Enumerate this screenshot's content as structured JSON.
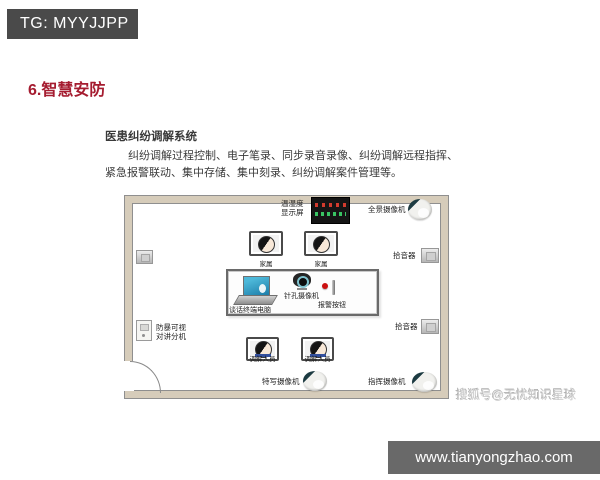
{
  "header": {
    "tg_badge": "TG: MYYJJPP",
    "title": "6.智慧安防"
  },
  "content": {
    "system_title": "医患纠纷调解系统",
    "description_line1": "纠纷调解过程控制、电子笔录、同步录音录像、纠纷调解远程指挥、",
    "description_line2": "紧急报警联动、集中存储、集中刻录、纠纷调解案件管理等。"
  },
  "diagram": {
    "temp_display_label": [
      "温湿度",
      "显示屏"
    ],
    "panoramic_camera_label": "全景摄像机",
    "family_labels": [
      "家属",
      "家属"
    ],
    "pickup_labels": [
      "拾音器",
      "拾音器"
    ],
    "intercom_label": [
      "防暴可视",
      "对讲分机"
    ],
    "terminal_pc_label": "谈话终端电脑",
    "pinhole_camera_label": "针孔摄像机",
    "alarm_button_label": "报警按钮",
    "mediator_labels": [
      "调解人员",
      "调解人员"
    ],
    "closeup_camera_label": "特写摄像机",
    "command_camera_label": "指挥摄像机",
    "icons": {
      "dome_camera": "dome-camera-icon",
      "wall_speaker": "speaker-icon",
      "laptop": "laptop-icon",
      "pinhole_camera": "pinhole-camera-icon",
      "alarm_button": "alarm-button-icon",
      "led_panel": "led-panel-icon",
      "intercom": "intercom-panel-icon",
      "person": "person-icon",
      "door": "door-arc"
    }
  },
  "footer": {
    "watermark": "搜狐号@无忧知识星球",
    "url": "www.tianyongzhao.com"
  },
  "colors": {
    "title_accent": "#a51c30",
    "badge_bg": "#4a4a4a",
    "footer_bg": "#696969",
    "wall": "#d6ccba",
    "laptop_screen": "#2f9dc6",
    "alarm_red": "#cc1111",
    "watermark_gray": "#c9c9c9"
  }
}
